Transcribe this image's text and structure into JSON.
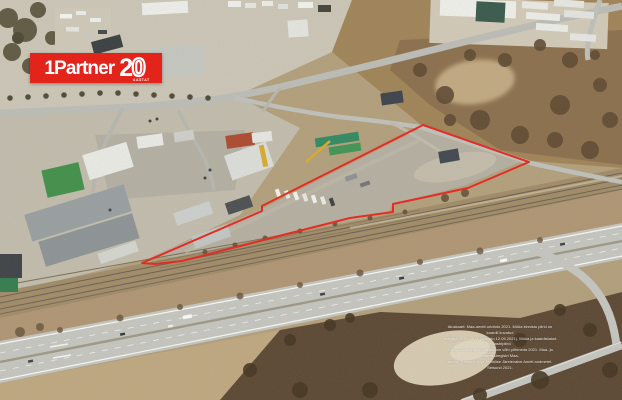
{
  "colors": {
    "brand_red": "#e3241b",
    "boundary_red": "#e8241c"
  },
  "logo": {
    "brand": "1Partner",
    "years": "20",
    "years_label": "AASTAT"
  },
  "boundary": {
    "points_attr": "142,263 262,211 262,206 423,125 529,162 468,188 393,204 393,212 350,218 275,237 182,261 155,264",
    "color": "#e8241c",
    "stroke_width": "2"
  },
  "attribution": {
    "lines": [
      "Aluskaart: Maa-ameti ortofoto 2021. Müüa kinnistu piirid on kaardil kuvatud",
      "seisuga 01.05.2021 (ortofoto 12.05.2021). Müüa ja kaardistatud katastripiirid",
      "2021–2025 ning informatsioon võib põhineda 2021. Maa- ja Aadressiregistri Maa-",
      "ameti, Transpordi- ja Tehnilise Järelevalve Ameti andmetel. Seisund 2021."
    ]
  }
}
